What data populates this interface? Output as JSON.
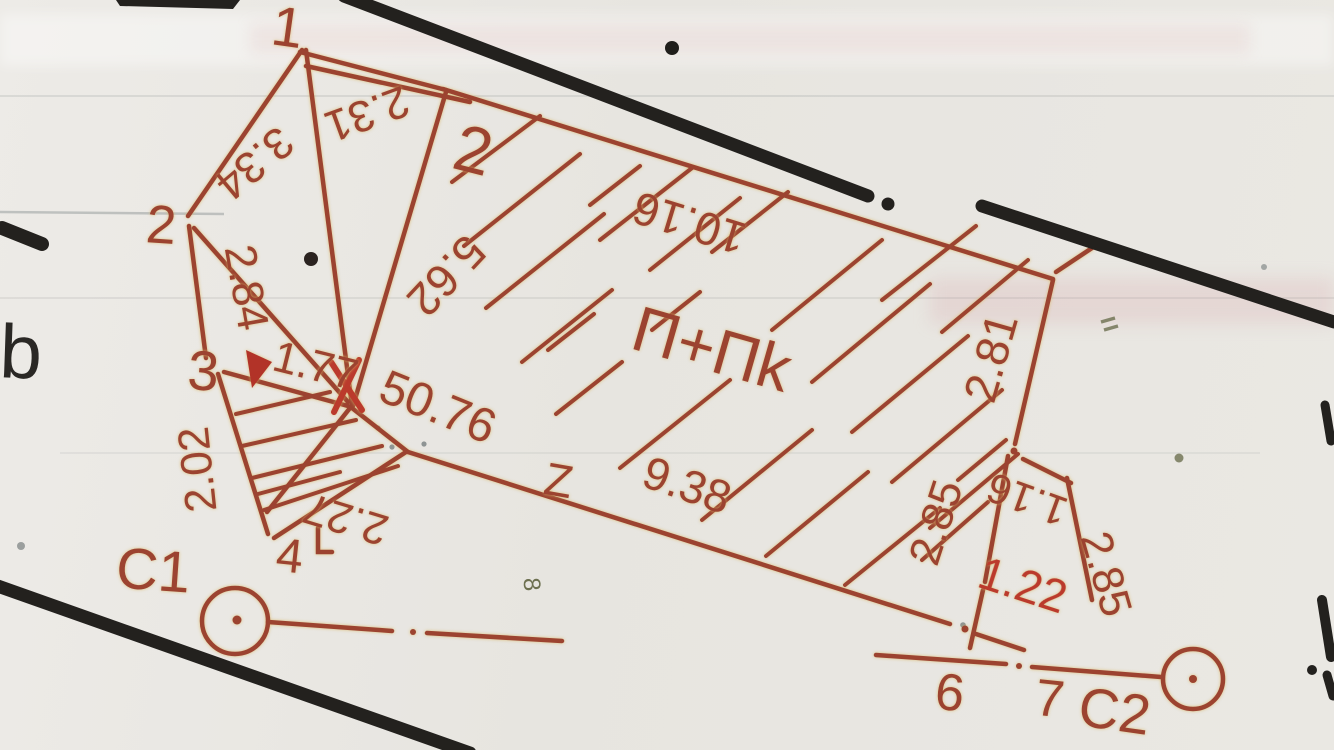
{
  "sketch": {
    "area_label": "П+Пk",
    "margin_letter": "b",
    "stations": {
      "c1": "C1",
      "c2": "C2"
    },
    "points": {
      "p1": "1",
      "p2_left": "2",
      "p2_top": "2",
      "p3": "3",
      "p4": "4",
      "p6": "6",
      "p7": "7",
      "z_mark": "Z"
    },
    "measurements": {
      "m_2_31": "2.31",
      "m_3_34": "3.34",
      "m_2_84": "2.84",
      "m_2_02": "2.02",
      "m_1_77": "1.77",
      "m_2_27": "2.27",
      "m_50_76": "50.76",
      "m_5_62": "5.62",
      "m_10_16": "10.16",
      "m_9_38": "9.38",
      "m_2_81": "2.81",
      "m_2_85_left": "2.85",
      "m_1_16": "1.16",
      "m_2_85_right": "2.85",
      "m_1_22": "1.22"
    },
    "pencil_marks": {
      "figure8": "8"
    },
    "colors": {
      "ink_red": "#9c4330",
      "ink_crimson": "#bb3a2c",
      "ink_black": "#23211e",
      "paper": "#e9e7e3",
      "pencil_grey": "#9aa0a0",
      "pencil_olive": "#6d7050"
    }
  }
}
